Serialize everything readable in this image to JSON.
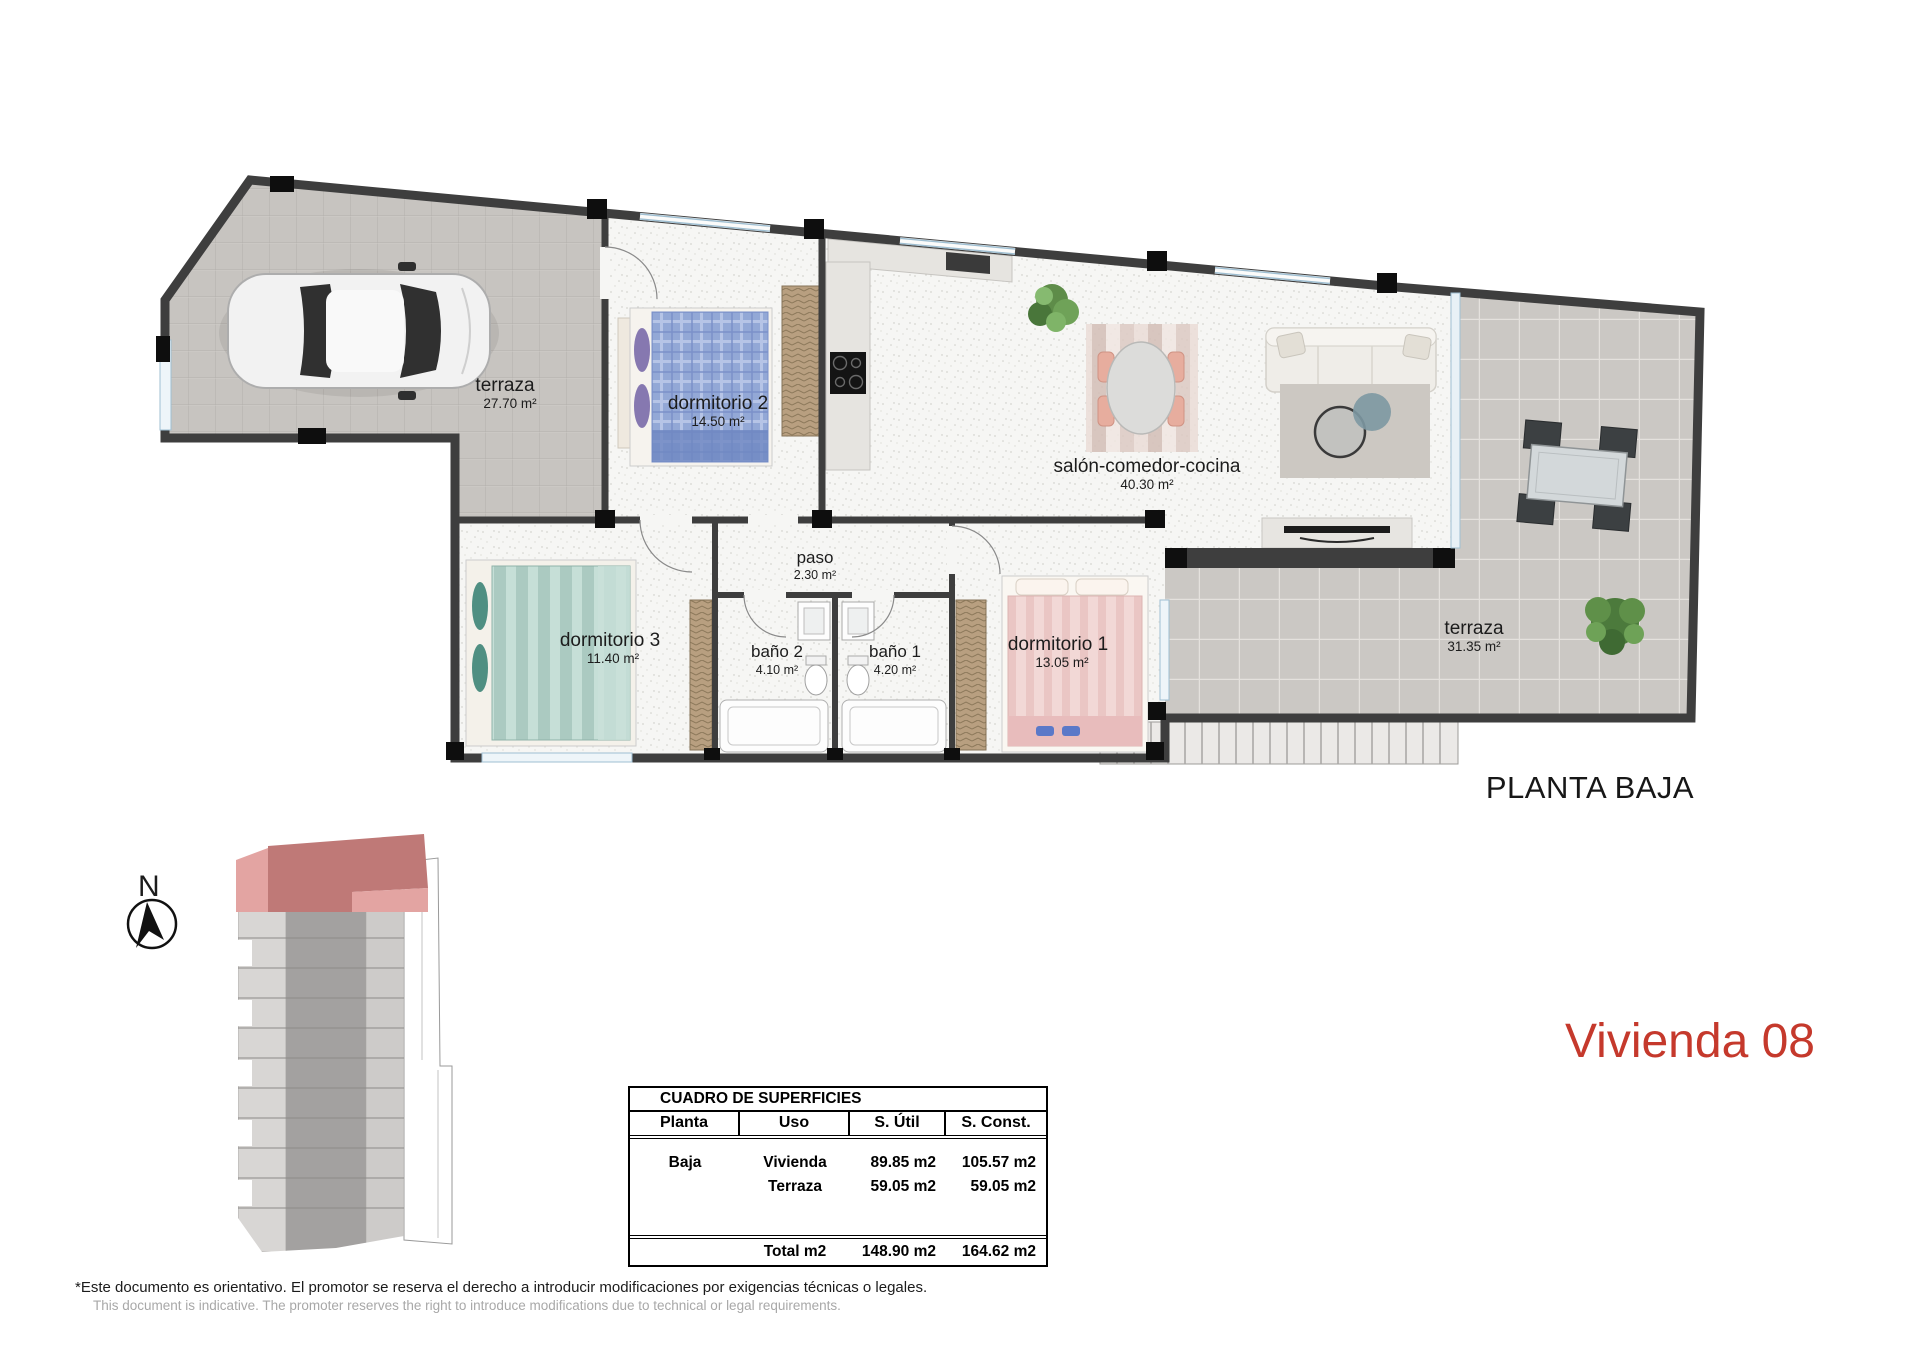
{
  "plan": {
    "title": "PLANTA BAJA",
    "north_label": "N",
    "rooms": {
      "terraza_garage": {
        "name": "terraza",
        "area": "27.70 m²"
      },
      "dormitorio2": {
        "name": "dormitorio 2",
        "area": "14.50 m²"
      },
      "salon": {
        "name": "salón-comedor-cocina",
        "area": "40.30 m²"
      },
      "paso": {
        "name": "paso",
        "area": "2.30 m²"
      },
      "dormitorio3": {
        "name": "dormitorio 3",
        "area": "11.40 m²"
      },
      "bano2": {
        "name": "baño 2",
        "area": "4.10 m²"
      },
      "bano1": {
        "name": "baño 1",
        "area": "4.20 m²"
      },
      "dormitorio1": {
        "name": "dormitorio 1",
        "area": "13.05 m²"
      },
      "terraza_right": {
        "name": "terraza",
        "area": "31.35 m²"
      }
    }
  },
  "unit": {
    "title": "Vivienda 08",
    "accent_color": "#c5392c"
  },
  "surfaces_table": {
    "title": "CUADRO DE SUPERFICIES",
    "headers": [
      "Planta",
      "Uso",
      "S. Útil",
      "S. Const."
    ],
    "rows": [
      {
        "planta": "Baja",
        "uso": "Vivienda",
        "util": "89.85 m2",
        "const": "105.57 m2"
      },
      {
        "planta": "",
        "uso": "Terraza",
        "util": "59.05 m2",
        "const": "59.05 m2"
      }
    ],
    "total": {
      "label": "Total m2",
      "util": "148.90 m2",
      "const": "164.62 m2"
    }
  },
  "footer": {
    "line_es": "*Este documento es orientativo. El promotor se reserva el derecho a introducir modificaciones por exigencias técnicas o legales.",
    "line_en": "This document is indicative. The promoter reserves the right to introduce modifications due to technical or legal requirements."
  }
}
